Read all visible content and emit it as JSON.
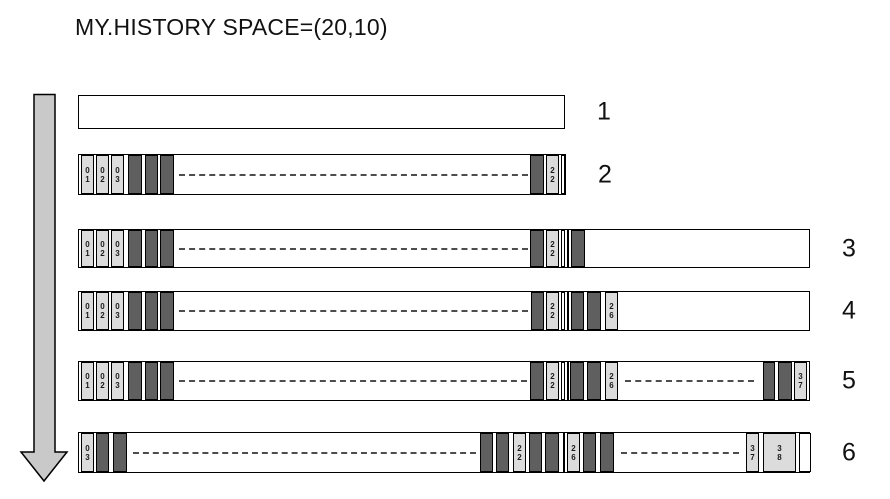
{
  "title": "MY.HISTORY SPACE=(20,10)",
  "colors": {
    "background": "#ffffff",
    "text": "#111111",
    "border": "#000000",
    "light_cell": "#dcdcdc",
    "dark_cell": "#5f5f5f",
    "dash": "#4d4d4d",
    "arrow_fill": "#c9c9c9"
  },
  "arrow": {
    "meaning": "time-progress-downward"
  },
  "diagram": {
    "rows": [
      {
        "label": "1",
        "top": 95,
        "left": 78,
        "width": 487,
        "height": 34,
        "segments": []
      },
      {
        "label": "2",
        "top": 154,
        "left": 78,
        "width": 488,
        "height": 41,
        "segments": [
          {
            "t": "light",
            "x": 2,
            "w": 13,
            "label": "0\n1"
          },
          {
            "t": "light",
            "x": 17,
            "w": 13,
            "label": "0\n2"
          },
          {
            "t": "light",
            "x": 32,
            "w": 13,
            "label": "0\n3"
          },
          {
            "t": "dark",
            "x": 49,
            "w": 14
          },
          {
            "t": "dark",
            "x": 66,
            "w": 13
          },
          {
            "t": "dark",
            "x": 81,
            "w": 14
          },
          {
            "t": "dash",
            "x": 100,
            "w": 349
          },
          {
            "t": "dark",
            "x": 451,
            "w": 14
          },
          {
            "t": "light",
            "x": 467,
            "w": 13,
            "label": "2\n2"
          },
          {
            "t": "white",
            "x": 482,
            "w": 4
          }
        ]
      },
      {
        "label": "3",
        "top": 229,
        "left": 78,
        "width": 732,
        "height": 39,
        "segments": [
          {
            "t": "light",
            "x": 2,
            "w": 13,
            "label": "0\n1"
          },
          {
            "t": "light",
            "x": 17,
            "w": 13,
            "label": "0\n2"
          },
          {
            "t": "light",
            "x": 32,
            "w": 13,
            "label": "0\n3"
          },
          {
            "t": "dark",
            "x": 49,
            "w": 14
          },
          {
            "t": "dark",
            "x": 66,
            "w": 13
          },
          {
            "t": "dark",
            "x": 81,
            "w": 14
          },
          {
            "t": "dash",
            "x": 100,
            "w": 349
          },
          {
            "t": "dark",
            "x": 451,
            "w": 14
          },
          {
            "t": "light",
            "x": 467,
            "w": 13,
            "label": "2\n2"
          },
          {
            "t": "white",
            "x": 482,
            "w": 4
          },
          {
            "t": "divider",
            "x": 488,
            "w": 2
          },
          {
            "t": "dark",
            "x": 492,
            "w": 14
          }
        ]
      },
      {
        "label": "4",
        "top": 291,
        "left": 78,
        "width": 732,
        "height": 40,
        "segments": [
          {
            "t": "light",
            "x": 2,
            "w": 13,
            "label": "0\n1"
          },
          {
            "t": "light",
            "x": 17,
            "w": 13,
            "label": "0\n2"
          },
          {
            "t": "light",
            "x": 32,
            "w": 13,
            "label": "0\n3"
          },
          {
            "t": "dark",
            "x": 49,
            "w": 14
          },
          {
            "t": "dark",
            "x": 66,
            "w": 13
          },
          {
            "t": "dark",
            "x": 81,
            "w": 14
          },
          {
            "t": "dash",
            "x": 100,
            "w": 349
          },
          {
            "t": "dark",
            "x": 452,
            "w": 13
          },
          {
            "t": "light",
            "x": 467,
            "w": 13,
            "label": "2\n2"
          },
          {
            "t": "white",
            "x": 482,
            "w": 4
          },
          {
            "t": "divider",
            "x": 488,
            "w": 2
          },
          {
            "t": "dark",
            "x": 492,
            "w": 13
          },
          {
            "t": "dark",
            "x": 508,
            "w": 14
          },
          {
            "t": "light",
            "x": 526,
            "w": 13,
            "label": "2\n6"
          }
        ]
      },
      {
        "label": "5",
        "top": 361,
        "left": 78,
        "width": 732,
        "height": 40,
        "segments": [
          {
            "t": "light",
            "x": 2,
            "w": 13,
            "label": "0\n1"
          },
          {
            "t": "light",
            "x": 17,
            "w": 13,
            "label": "0\n2"
          },
          {
            "t": "light",
            "x": 32,
            "w": 13,
            "label": "0\n3"
          },
          {
            "t": "dark",
            "x": 49,
            "w": 14
          },
          {
            "t": "dark",
            "x": 66,
            "w": 13
          },
          {
            "t": "dark",
            "x": 81,
            "w": 14
          },
          {
            "t": "dash",
            "x": 100,
            "w": 348
          },
          {
            "t": "dark",
            "x": 451,
            "w": 14
          },
          {
            "t": "light",
            "x": 467,
            "w": 13,
            "label": "2\n2"
          },
          {
            "t": "white",
            "x": 482,
            "w": 4
          },
          {
            "t": "divider",
            "x": 488,
            "w": 2
          },
          {
            "t": "dark",
            "x": 491,
            "w": 14
          },
          {
            "t": "dark",
            "x": 508,
            "w": 14
          },
          {
            "t": "light",
            "x": 526,
            "w": 13,
            "label": "2\n6"
          },
          {
            "t": "dash",
            "x": 546,
            "w": 129
          },
          {
            "t": "dark",
            "x": 684,
            "w": 12
          },
          {
            "t": "dark",
            "x": 699,
            "w": 14
          },
          {
            "t": "light",
            "x": 715,
            "w": 13,
            "label": "3\n7"
          }
        ]
      },
      {
        "label": "6",
        "top": 432,
        "left": 78,
        "width": 732,
        "height": 41,
        "segments": [
          {
            "t": "light",
            "x": 2,
            "w": 13,
            "label": "0\n3"
          },
          {
            "t": "dark",
            "x": 17,
            "w": 13
          },
          {
            "t": "dark",
            "x": 34,
            "w": 14
          },
          {
            "t": "dash",
            "x": 54,
            "w": 343
          },
          {
            "t": "dark",
            "x": 401,
            "w": 13
          },
          {
            "t": "dark",
            "x": 417,
            "w": 13
          },
          {
            "t": "light",
            "x": 434,
            "w": 13,
            "label": "2\n2"
          },
          {
            "t": "dark",
            "x": 450,
            "w": 13
          },
          {
            "t": "dark",
            "x": 466,
            "w": 14
          },
          {
            "t": "divider",
            "x": 484,
            "w": 2
          },
          {
            "t": "light",
            "x": 488,
            "w": 13,
            "label": "2\n6"
          },
          {
            "t": "dark",
            "x": 504,
            "w": 13
          },
          {
            "t": "dark",
            "x": 521,
            "w": 14
          },
          {
            "t": "dash",
            "x": 542,
            "w": 118
          },
          {
            "t": "light",
            "x": 667,
            "w": 13,
            "label": "3\n7"
          },
          {
            "t": "light",
            "x": 684,
            "w": 33,
            "label": "3\n8"
          },
          {
            "t": "white",
            "x": 720,
            "w": 12
          }
        ]
      }
    ]
  }
}
